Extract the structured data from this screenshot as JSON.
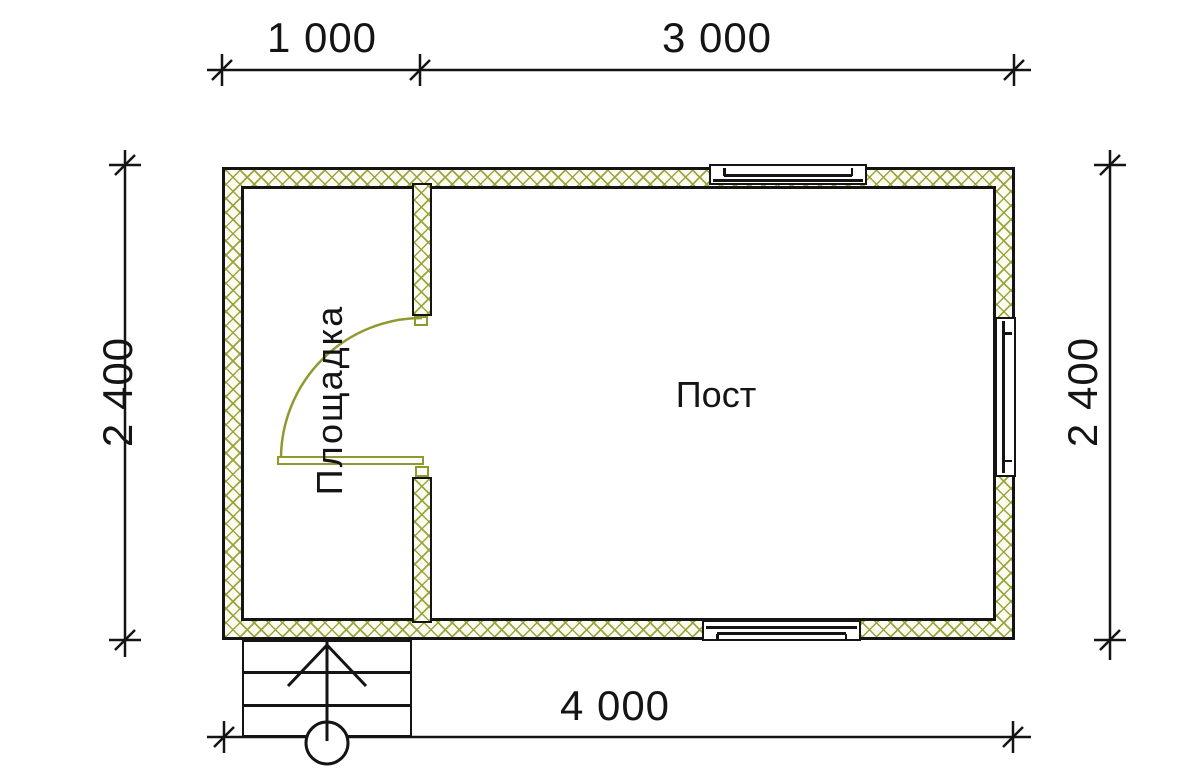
{
  "plan": {
    "dimensions": {
      "top_left": "1 000",
      "top_right": "3 000",
      "side_left": "2 400",
      "side_right": "2 400",
      "bottom": "4 000"
    },
    "rooms": {
      "left_room_label": "Площадка",
      "right_room_label": "Пост"
    },
    "watermark": {
      "brand": "VANDA"
    },
    "colors": {
      "wall_hatch": "#96a038",
      "door_olive": "#8f992e",
      "line_black": "#141414",
      "watermark_pink": "#f7c6ca",
      "watermark_blue_front": "#ccdcee",
      "watermark_blue_top": "#dbe9f8",
      "watermark_blue_side": "#b7cbe2"
    }
  }
}
